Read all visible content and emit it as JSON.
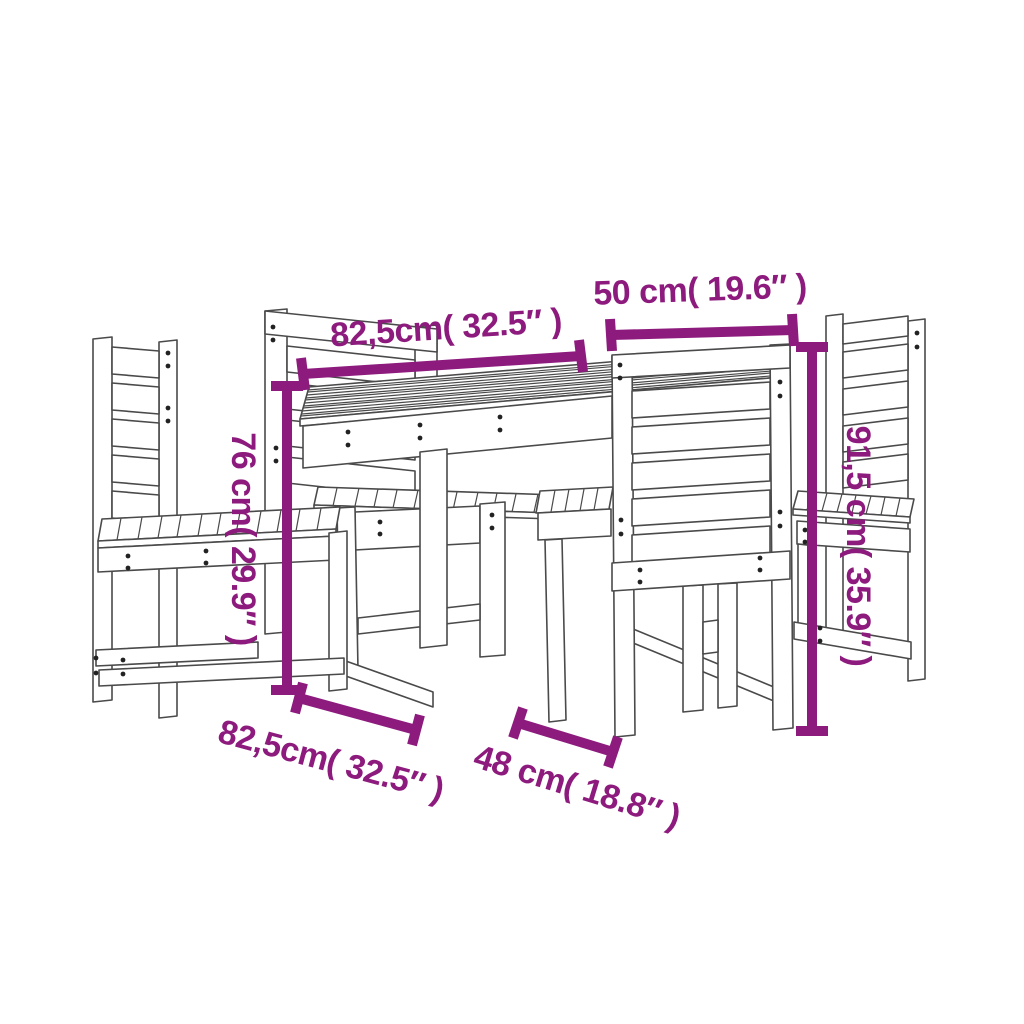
{
  "diagram": {
    "type": "product-dimension-diagram",
    "subject": "5-piece wooden garden dining set: slatted table with four slat-back chairs, perspective line drawing",
    "accent_color": "#8d1a7d",
    "line_color": "#4a4a4a",
    "background_color": "#ffffff",
    "dimensions": {
      "table_width": "82,5cm( 32.5″ )",
      "chair_width": "50 cm( 19.6″ )",
      "table_height": "76 cm( 29.9″ )",
      "chair_height": "91,5 cm( 35.9″ )",
      "table_depth": "82,5cm( 32.5″ )",
      "chair_depth": "48 cm( 18.8″ )"
    }
  }
}
